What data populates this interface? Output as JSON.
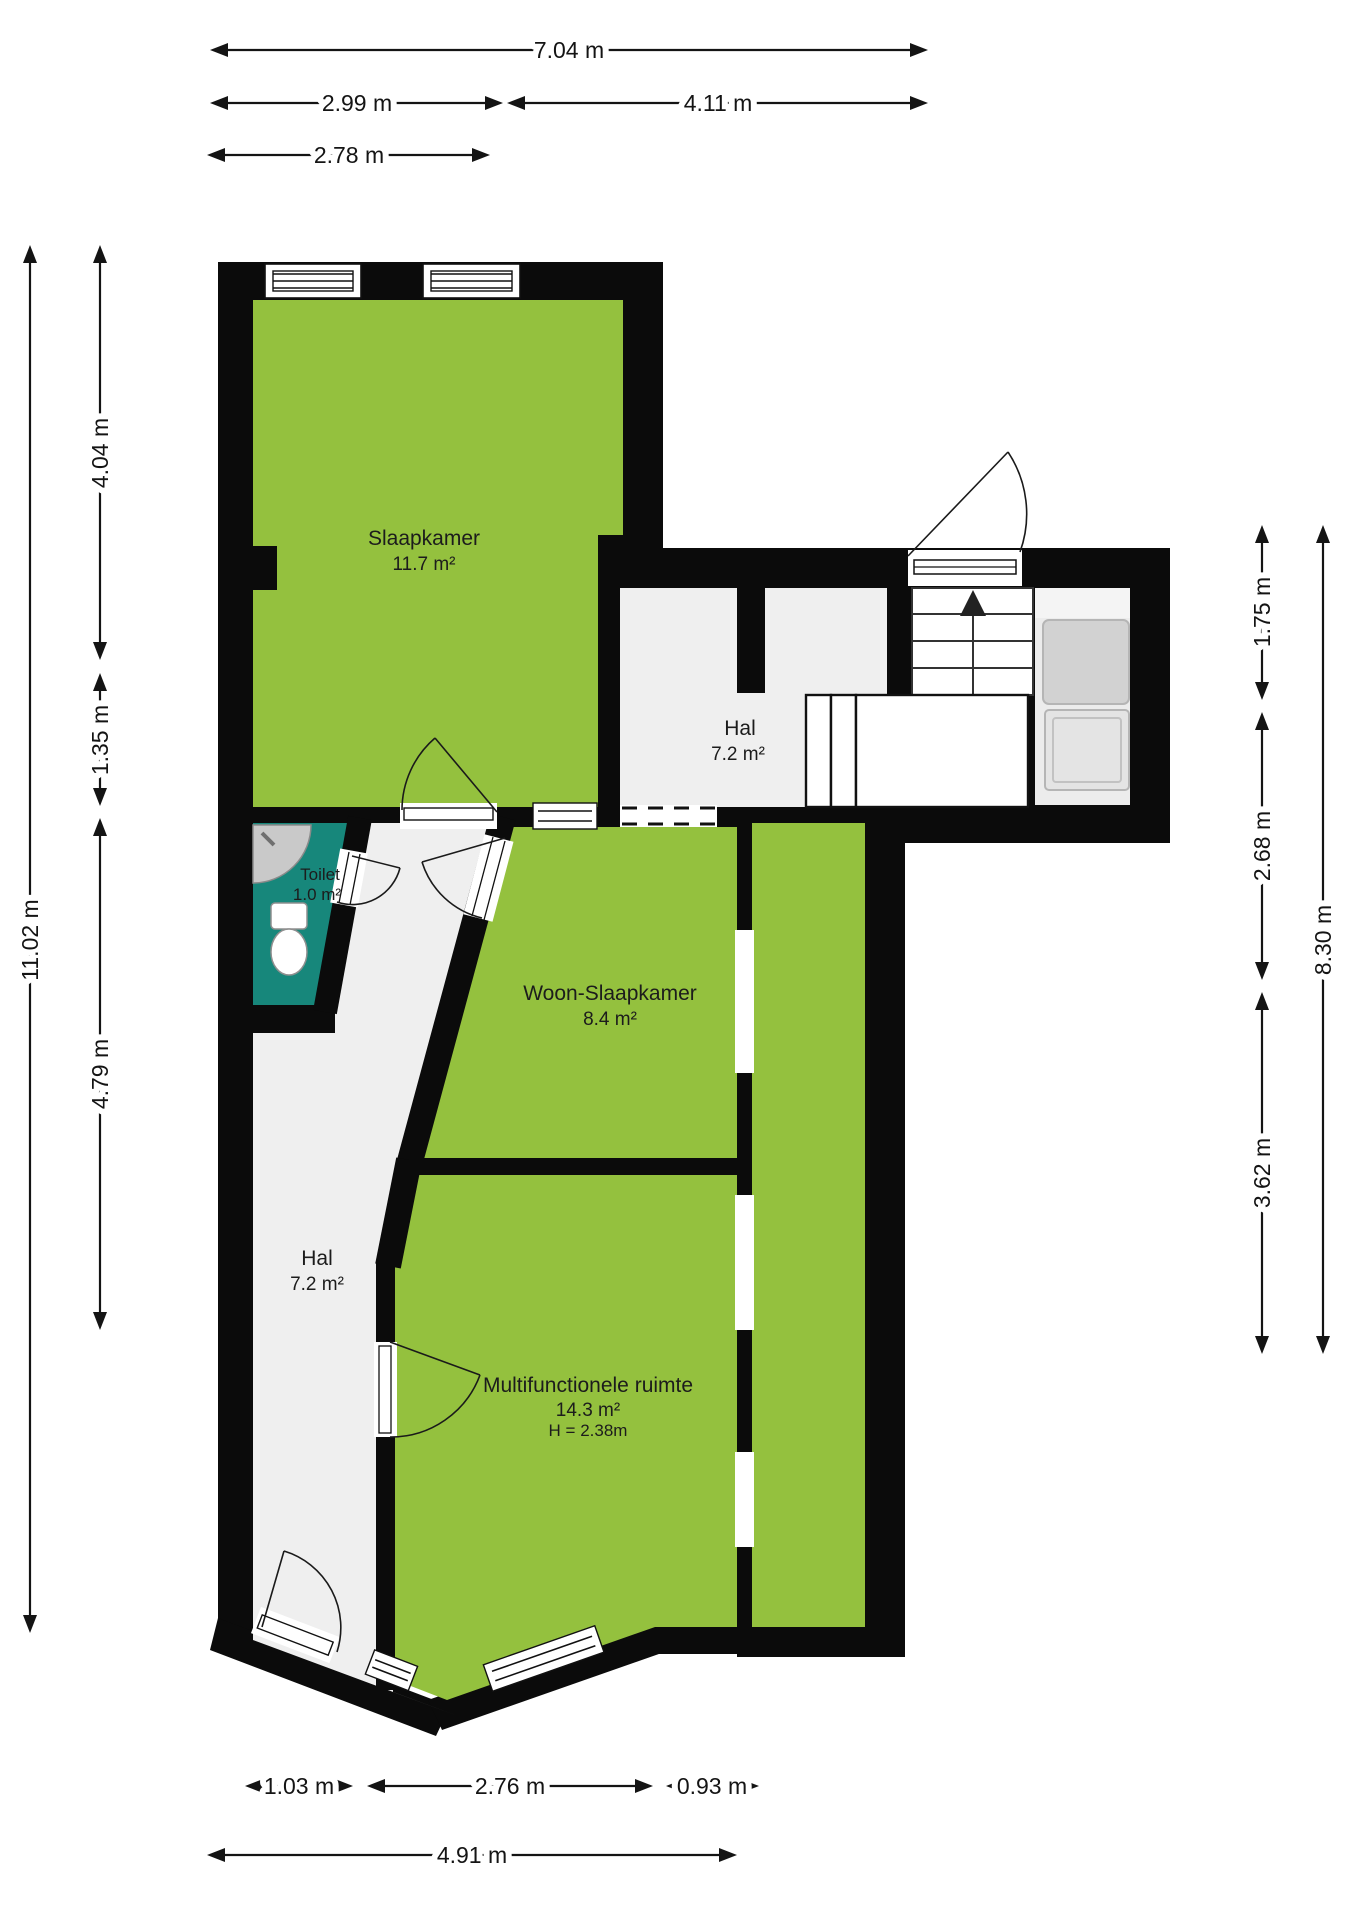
{
  "plan": {
    "rooms": {
      "slaapkamer": {
        "name": "Slaapkamer",
        "area": "11.7 m²"
      },
      "hal_boven": {
        "name": "Hal",
        "area": "7.2 m²"
      },
      "toilet": {
        "name": "Toilet",
        "area": "1.0 m²"
      },
      "woon": {
        "name": "Woon-Slaapkamer",
        "area": "8.4 m²"
      },
      "hal_beneden": {
        "name": "Hal",
        "area": "7.2 m²"
      },
      "multi": {
        "name": "Multifunctionele ruimte",
        "area": "14.3 m²",
        "height": "H = 2.38m"
      }
    },
    "dimensions": {
      "top": [
        "7.04 m",
        "2.99 m",
        "4.11 m",
        "2.78 m"
      ],
      "left": [
        "11.02 m",
        "4.04 m",
        "1.35 m",
        "4.79 m"
      ],
      "right": [
        "1.75 m",
        "2.68 m",
        "3.62 m",
        "8.30 m"
      ],
      "bottom": [
        "1.03 m",
        "2.76 m",
        "0.93 m",
        "4.91 m"
      ]
    },
    "stairs": {
      "direction_arrow": "up"
    },
    "colors": {
      "room_green": "#94c13e",
      "toilet_teal": "#17877b",
      "wall_black": "#0b0b0b",
      "hall_floor": "#efefef"
    }
  }
}
